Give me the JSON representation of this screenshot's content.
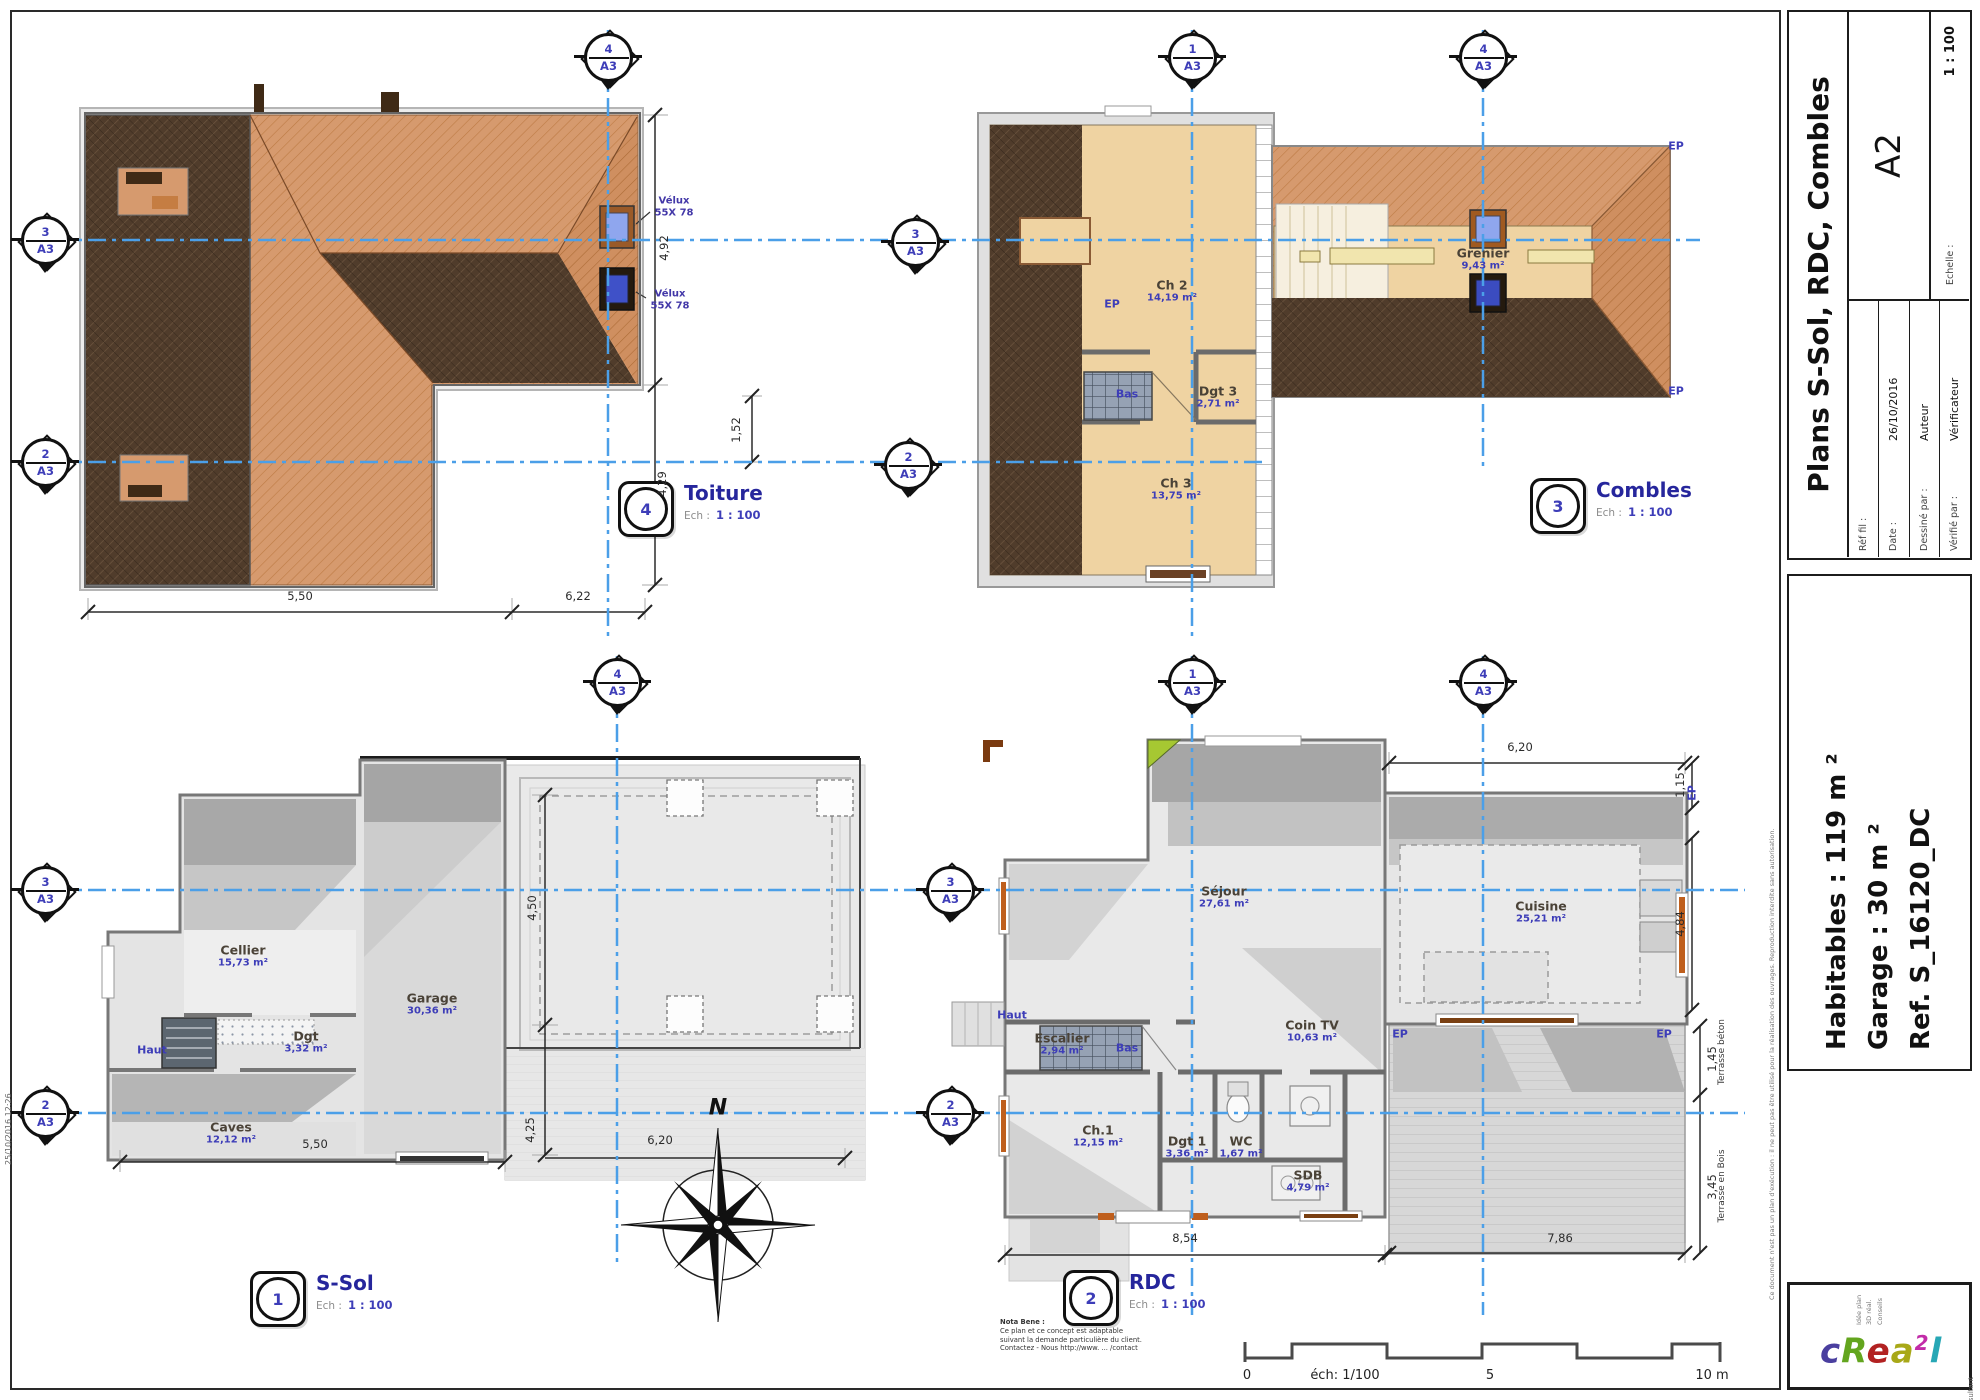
{
  "colors": {
    "axis_blue": "#4b9fe8",
    "label_purple": "#3d3db8",
    "title_blue": "#26269c",
    "roof_salmon": "#d69a6e",
    "roof_dark": "#503c2b",
    "attic_beige": "#efd3a2",
    "logo_letters": [
      "#4a3f9f",
      "#63a51e",
      "#b22222",
      "#a8a818",
      "#c22ba8",
      "#27a7b5"
    ]
  },
  "title_block": {
    "title": "Plans S-Sol, RDC, Combles",
    "format": "A2",
    "scale_label": "Echelle :",
    "scale_value": "1 : 100",
    "fields": [
      {
        "label": "Réf fil :",
        "value": ""
      },
      {
        "label": "Date :",
        "value": "26/10/2016"
      },
      {
        "label": "Dessiné par :",
        "value": "Auteur"
      },
      {
        "label": "Vérifié par :",
        "value": "Vérificateur"
      }
    ],
    "summary": [
      "Habitables : 119 m ²",
      "Garage : 30 m ²",
      "Ref. S_16120_DC"
    ]
  },
  "plans": {
    "toiture": {
      "num": "4",
      "title": "Toiture",
      "ech_label": "Ech :",
      "scale": "1 : 100",
      "velux": {
        "name": "Vélux",
        "size": "55X 78"
      },
      "dims": {
        "w1": "5,50",
        "w2": "6,22",
        "h1": "4,92",
        "h2": "4,29"
      }
    },
    "combles": {
      "num": "3",
      "title": "Combles",
      "ech_label": "Ech :",
      "scale": "1 : 100",
      "rooms": {
        "ch2": {
          "name": "Ch 2",
          "area": "14,19 m²"
        },
        "dgt3": {
          "name": "Dgt 3",
          "area": "2,71 m²"
        },
        "ch3": {
          "name": "Ch 3",
          "area": "13,75 m²"
        },
        "grenier": {
          "name": "Grenier",
          "area": "9,43 m²"
        }
      },
      "stair_down": "Bas",
      "dim_left": "1,52"
    },
    "ssol": {
      "num": "1",
      "title": "S-Sol",
      "ech_label": "Ech :",
      "scale": "1 : 100",
      "rooms": {
        "cellier": {
          "name": "Cellier",
          "area": "15,73 m²"
        },
        "garage": {
          "name": "Garage",
          "area": "30,36 m²"
        },
        "dgt": {
          "name": "Dgt",
          "area": "3,32 m²"
        },
        "caves": {
          "name": "Caves",
          "area": "12,12 m²"
        }
      },
      "stair_up": "Haut",
      "compass": "N",
      "dims": {
        "b": "5,50",
        "t": "6,20",
        "v1": "4,50",
        "v2": "4,25"
      }
    },
    "rdc": {
      "num": "2",
      "title": "RDC",
      "ech_label": "Ech :",
      "scale": "1 : 100",
      "rooms": {
        "sejour": {
          "name": "Séjour",
          "area": "27,61 m²"
        },
        "cuisine": {
          "name": "Cuisine",
          "area": "25,21 m²"
        },
        "cointv": {
          "name": "Coin TV",
          "area": "10,63 m²"
        },
        "escalier": {
          "name": "Escalier",
          "area": "2,94 m²"
        },
        "ch1": {
          "name": "Ch.1",
          "area": "12,15 m²"
        },
        "dgt1": {
          "name": "Dgt 1",
          "area": "3,36 m²"
        },
        "wc": {
          "name": "WC",
          "area": "1,67 m²"
        },
        "sdb": {
          "name": "SDB",
          "area": "4,79 m²"
        }
      },
      "stair_down": "Bas",
      "stair_up": "Haut",
      "terrasse_bois": "Terrasse en Bois",
      "terrasse_beton": "Terrasse béton",
      "dims": {
        "top": "6,20",
        "r1": "1,15",
        "r2": "4,84",
        "r3": "1,45",
        "r4": "3,45",
        "b1": "8,54",
        "b2": "7,86"
      }
    }
  },
  "labels": {
    "ep": "EP"
  },
  "markers": {
    "ref": "A3",
    "items": [
      {
        "n": "4"
      },
      {
        "n": "1"
      },
      {
        "n": "4"
      },
      {
        "n": "3"
      },
      {
        "n": "2"
      },
      {
        "n": "3"
      },
      {
        "n": "2"
      },
      {
        "n": "4"
      },
      {
        "n": "1"
      },
      {
        "n": "4"
      },
      {
        "n": "3"
      },
      {
        "n": "2"
      },
      {
        "n": "3"
      },
      {
        "n": "2"
      }
    ]
  },
  "scale_bar": {
    "zero": "0",
    "ech": "éch: 1/100",
    "five": "5",
    "ten": "10 m"
  },
  "logo": {
    "l1": "c",
    "l2": "R",
    "l3": "e",
    "l4": "a",
    "l5": "2",
    "l6": "l",
    "copyright": "© Consultant",
    "lines": [
      "Idée plan",
      "3D réal.",
      "Conseils"
    ]
  },
  "fine_print": {
    "nota": [
      "Nota Bene :",
      "Ce plan et ce concept est adaptable",
      "suivant la demande particulière du client.",
      "Contactez - Nous  http://www. ... /contact"
    ],
    "strip": "Ce document n'est pas un plan d'exécution : il ne peut pas être utilisé pour la réalisation des ouvrages. Reproduction interdite sans autorisation.",
    "stamp": "25/10/2016 12:26"
  }
}
